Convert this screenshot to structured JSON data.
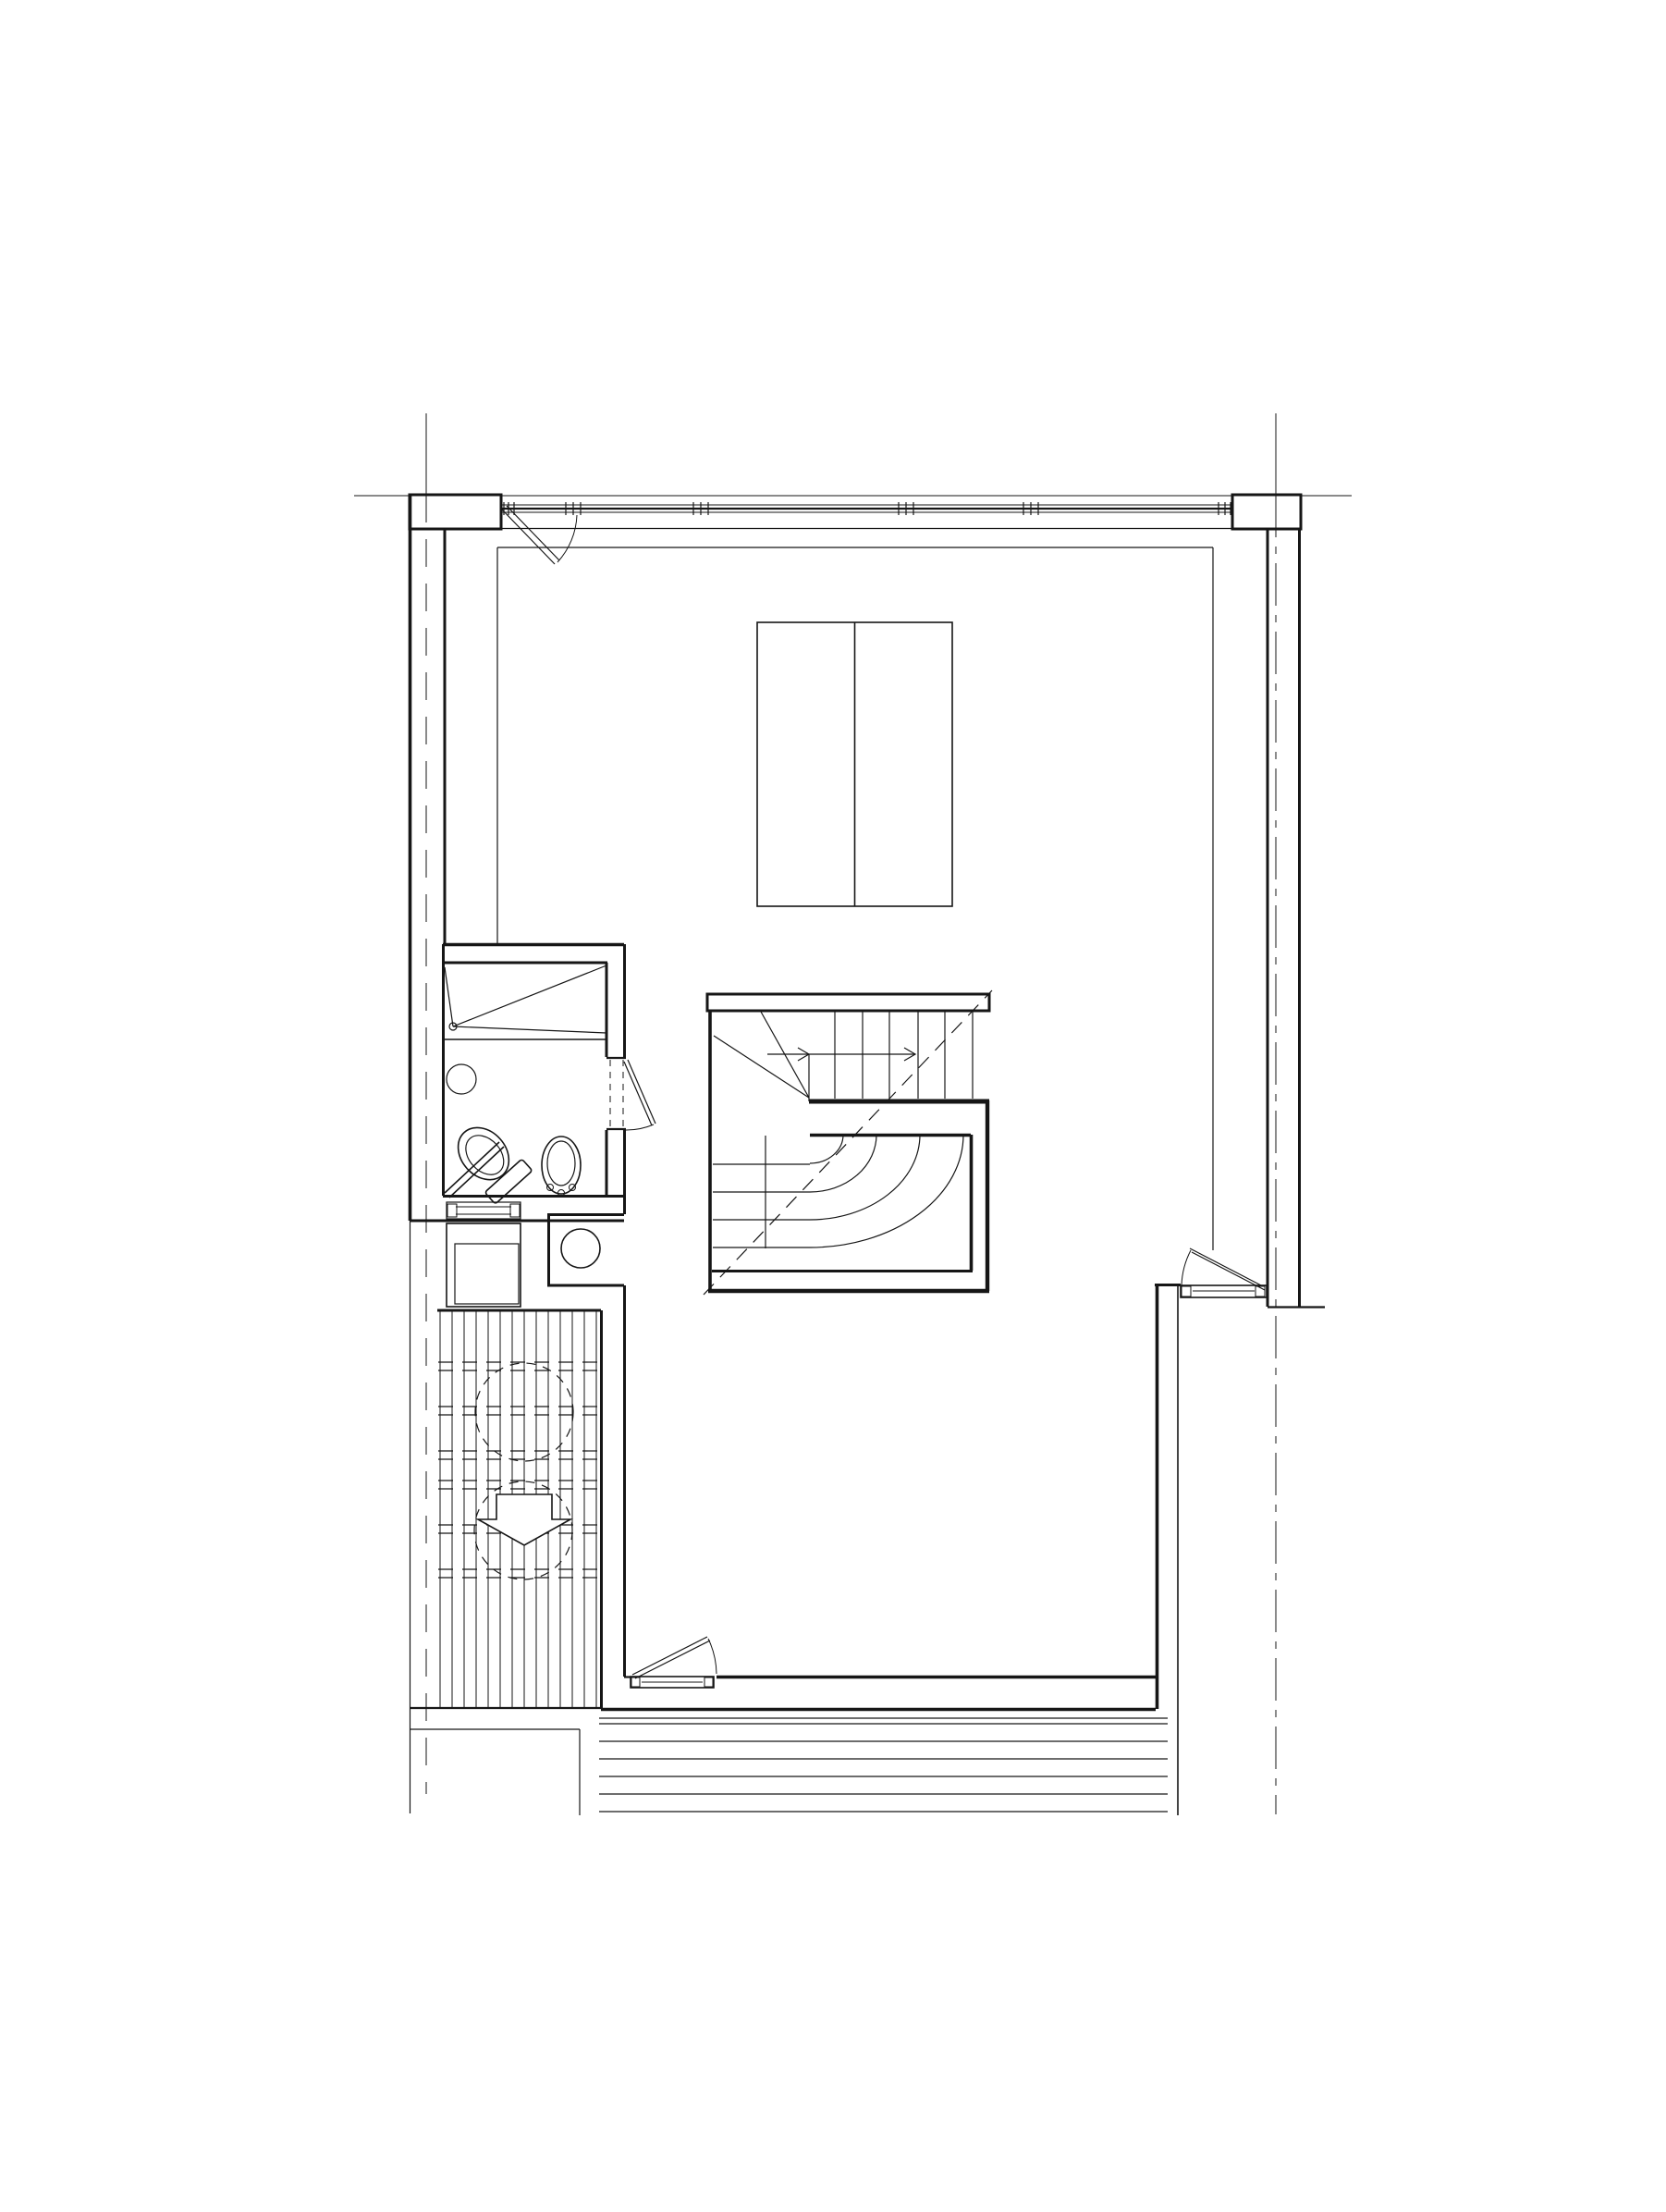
{
  "page": {
    "title": "Architectural floor plan — upper level",
    "background_color": "#ffffff",
    "line_color": "#161616"
  },
  "drawing": {
    "type": "architectural-floor-plan",
    "description": "Monochrome CAD floor plan: north window band with mullions and entry door swing, large room with double wardrobe outline, central U-return staircase with winder treads and dashed direction line, west bathroom with walk-in shower, WC and basin, utility recess with cylinder, appliance square, slatted outdoor deck with two dashed canopy circles and a down arrow, south door onto external steps, east door swing, dashed structural grid lines.",
    "labels": {
      "grid": "dashed structural grid reference lines",
      "facade": "north facade window band with mullions",
      "walls": "exterior and interior wall lines",
      "entry_door": "entry door swing at north-west corner",
      "wardrobe": "double wardrobe / bed outline",
      "staircase": "U-return staircase with winder treads and up-direction line",
      "bathroom": "bathroom with walk-in shower, WC and wash basin",
      "bath_door": "bathroom door swing",
      "utility": "utility recess with hot-water cylinder",
      "appliance": "appliance square below bathroom",
      "threshold": "bathroom threshold strip",
      "deck": "slatted timber deck with dashed canopy circles and down arrow",
      "south_door": "south door onto external steps",
      "east_door": "east door swing to outside",
      "external_steps": "external steps at south edge",
      "walkway": "west walkway edge lines"
    },
    "counts": {
      "window_mullion_clusters": 6,
      "upper_flight_treads": 7,
      "lower_flight_treads": 5,
      "winder_arcs": 4,
      "deck_boards": 14,
      "deck_dashed_rows": 6,
      "dashed_circles": 2,
      "external_steps": 7,
      "door_swings": 4
    },
    "mullion_positions_x": [
      549,
      620,
      758,
      980,
      1115,
      1325
    ],
    "colors": {
      "ink": "#161616",
      "paper": "#ffffff"
    }
  }
}
